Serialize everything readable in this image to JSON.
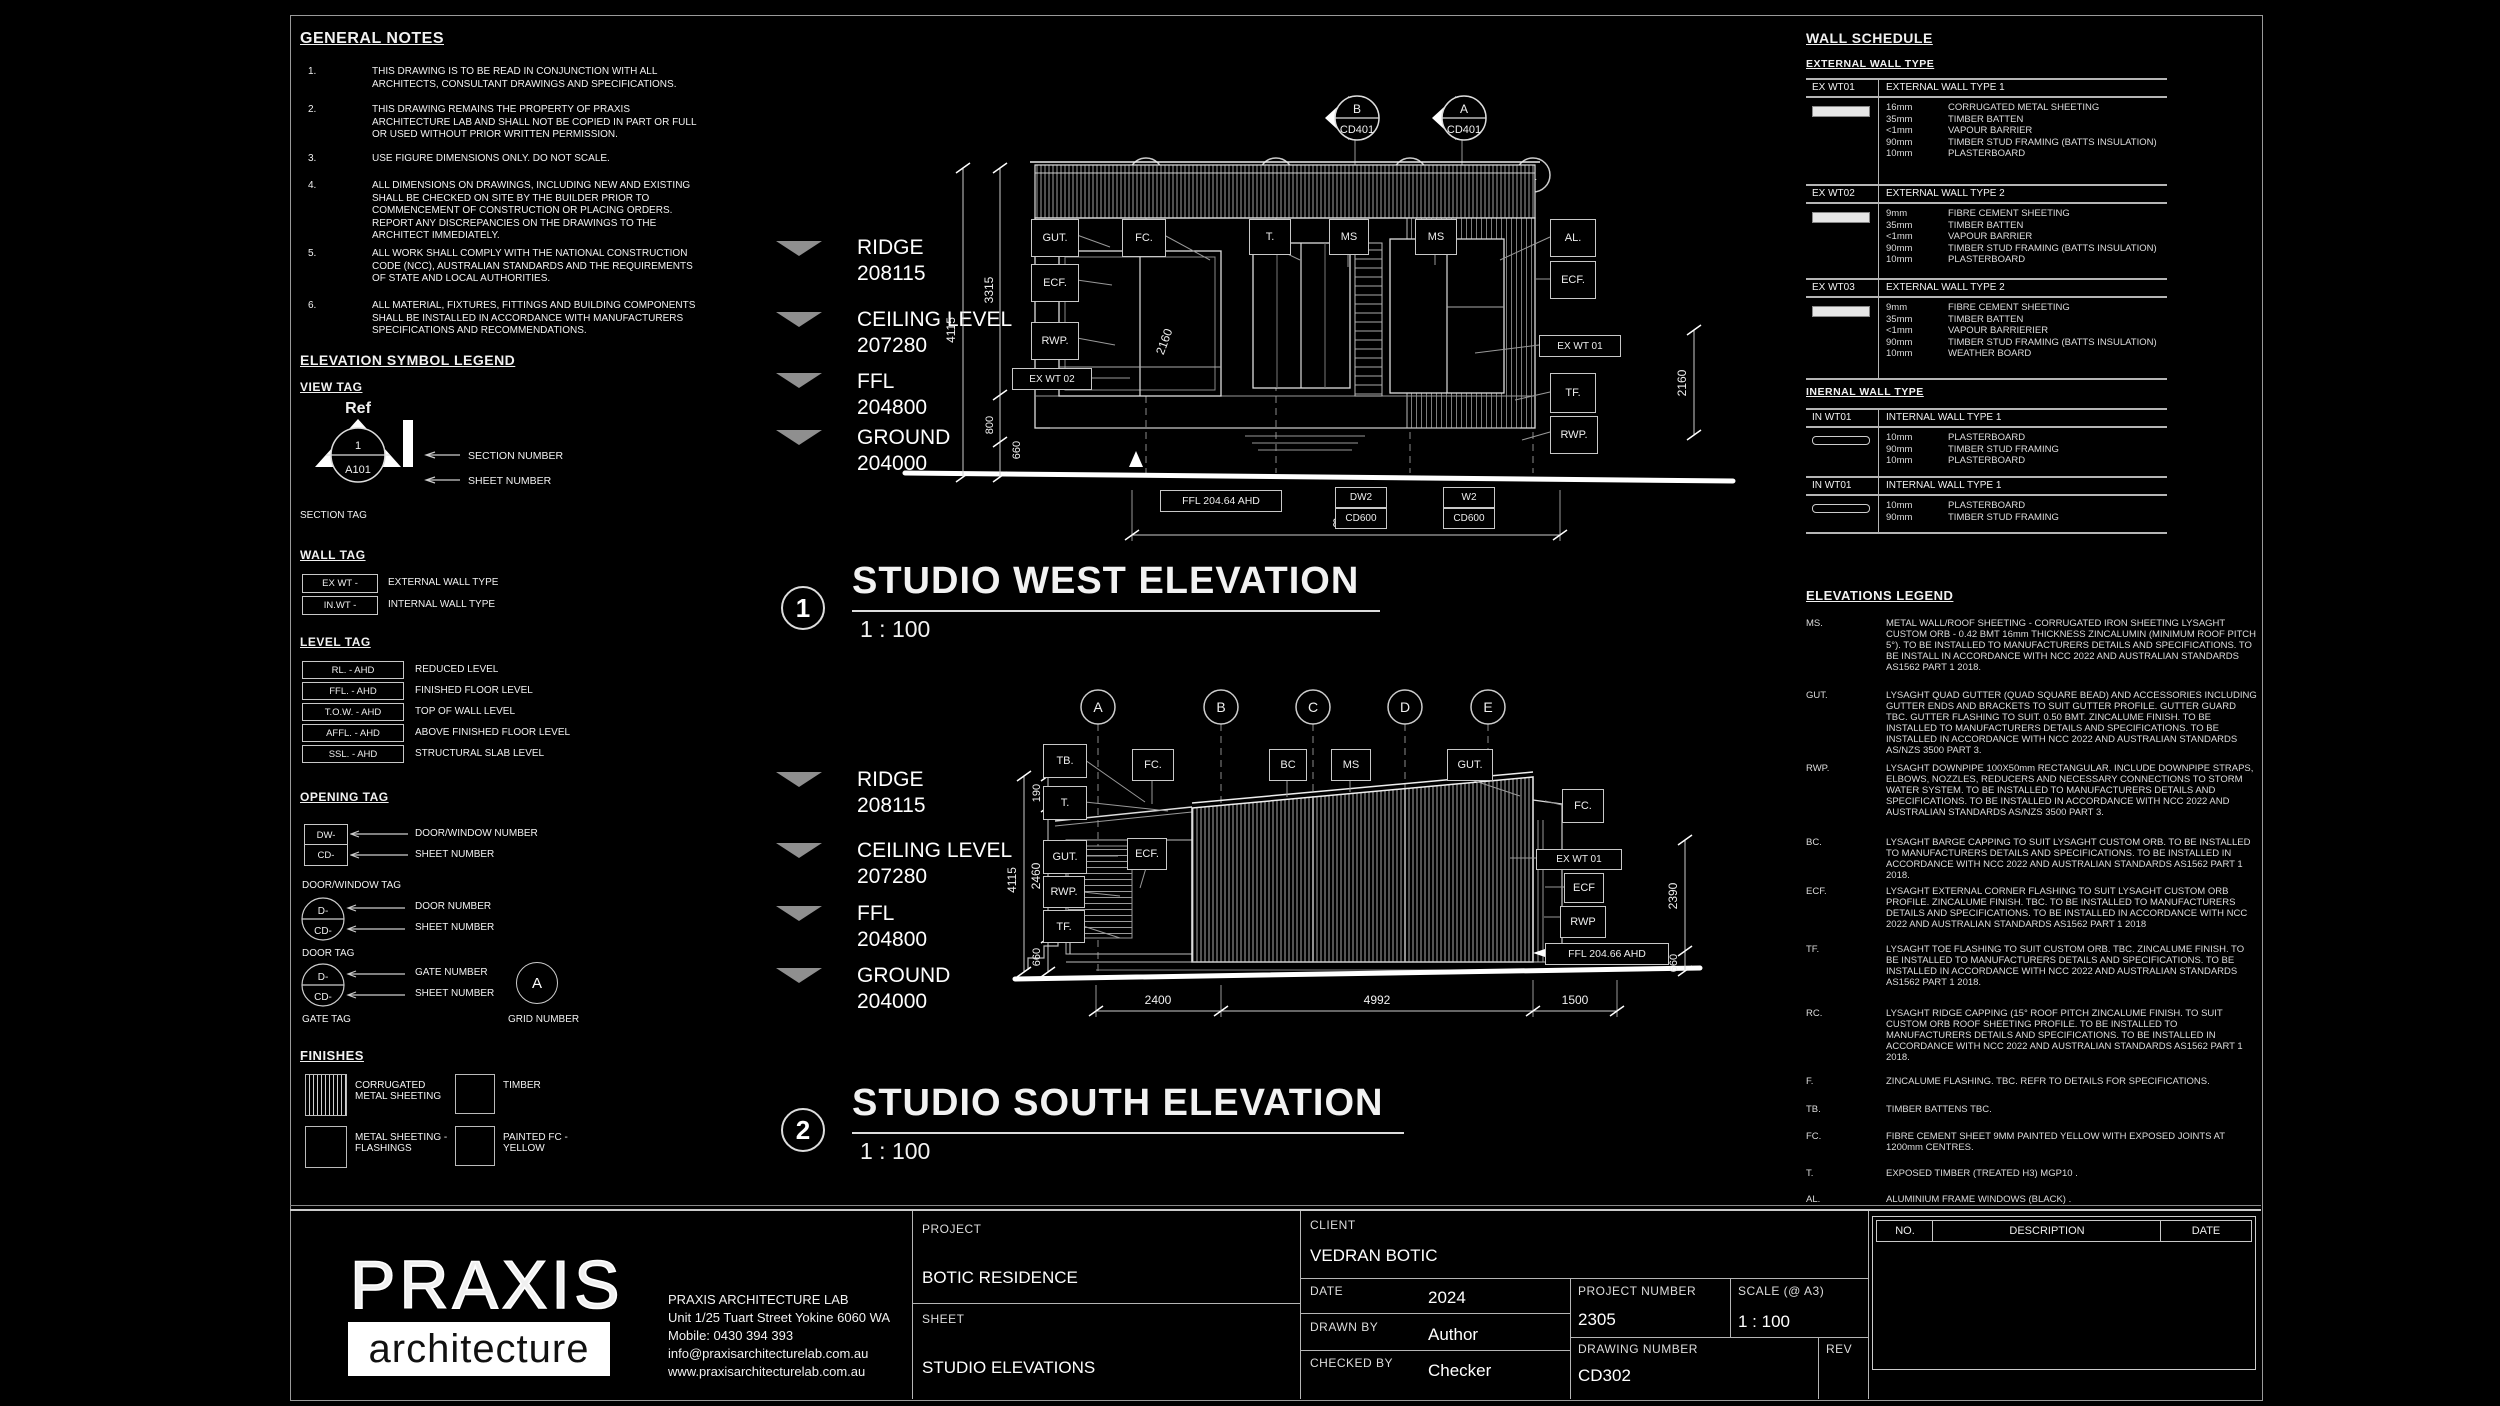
{
  "general_notes": {
    "title": "GENERAL NOTES",
    "items": [
      {
        "num": "1.",
        "text": "THIS DRAWING IS TO BE READ IN CONJUNCTION WITH ALL ARCHITECTS, CONSULTANT DRAWINGS AND SPECIFICATIONS."
      },
      {
        "num": "2.",
        "text": "THIS DRAWING REMAINS THE PROPERTY OF PRAXIS ARCHITECTURE LAB AND SHALL NOT BE COPIED IN PART OR FULL OR USED WITHOUT PRIOR WRITTEN PERMISSION."
      },
      {
        "num": "3.",
        "text": "USE FIGURE DIMENSIONS ONLY. DO NOT SCALE."
      },
      {
        "num": "4.",
        "text": "ALL DIMENSIONS ON DRAWINGS, INCLUDING NEW AND EXISTING SHALL BE CHECKED ON SITE BY THE BUILDER PRIOR TO COMMENCEMENT OF CONSTRUCTION OR PLACING ORDERS. REPORT ANY DISCREPANCIES ON THE DRAWINGS TO THE ARCHITECT IMMEDIATELY."
      },
      {
        "num": "5.",
        "text": "ALL WORK SHALL COMPLY WITH THE NATIONAL CONSTRUCTION CODE (NCC), AUSTRALIAN STANDARDS AND THE REQUIREMENTS OF STATE AND LOCAL AUTHORITIES."
      },
      {
        "num": "6.",
        "text": "ALL MATERIAL, FIXTURES, FITTINGS AND BUILDING COMPONENTS SHALL BE INSTALLED IN ACCORDANCE WITH MANUFACTURERS SPECIFICATIONS AND RECOMMENDATIONS."
      }
    ]
  },
  "symbol_legend": {
    "title": "ELEVATION SYMBOL LEGEND",
    "view_tag": {
      "title": "VIEW TAG",
      "ref": "Ref",
      "num": "1",
      "sheet": "A101",
      "section_number": "SECTION NUMBER",
      "sheet_number": "SHEET NUMBER",
      "caption": "SECTION TAG"
    },
    "wall_tag": {
      "title": "WALL TAG",
      "ex": "EX WT -",
      "ex_label": "EXTERNAL WALL TYPE",
      "in": "IN.WT -",
      "in_label": "INTERNAL WALL TYPE"
    },
    "level_tag": {
      "title": "LEVEL TAG",
      "rows": [
        [
          "RL. - AHD",
          "REDUCED LEVEL"
        ],
        [
          "FFL. - AHD",
          "FINISHED FLOOR LEVEL"
        ],
        [
          "T.O.W. - AHD",
          "TOP OF WALL LEVEL"
        ],
        [
          "AFFL. - AHD",
          "ABOVE FINISHED FLOOR LEVEL"
        ],
        [
          "SSL. - AHD",
          "STRUCTURAL SLAB LEVEL"
        ]
      ]
    },
    "opening_tag": {
      "title": "OPENING TAG",
      "dw": "DW-",
      "cd": "CD-",
      "dw_num": "DOOR/WINDOW NUMBER",
      "sheet_num": "SHEET NUMBER",
      "dw_caption": "DOOR/WINDOW TAG",
      "d": "D-",
      "cd2": "CD-",
      "door_num": "DOOR NUMBER",
      "sheet_num2": "SHEET NUMBER",
      "door_caption": "DOOR TAG",
      "d2": "D-",
      "cd3": "CD-",
      "gate_num": "GATE NUMBER",
      "sheet_num3": "SHEET NUMBER",
      "gate_caption": "GATE TAG",
      "grid_letter": "A",
      "grid_caption": "GRID NUMBER"
    },
    "finishes": {
      "title": "FINISHES",
      "items": [
        "CORRUGATED METAL SHEETING",
        "TIMBER",
        "METAL SHEETING - FLASHINGS",
        "PAINTED FC - YELLOW"
      ]
    }
  },
  "levels": [
    {
      "label": "RIDGE",
      "value": "208115"
    },
    {
      "label": "CEILING LEVEL",
      "value": "207280"
    },
    {
      "label": "FFL",
      "value": "204800"
    },
    {
      "label": "GROUND",
      "value": "204000"
    }
  ],
  "west": {
    "num": "1",
    "title": "STUDIO WEST ELEVATION",
    "scale": "1 : 100",
    "grids": [
      "4",
      "3",
      "2",
      "1"
    ],
    "sections": [
      {
        "letter": "B",
        "sheet": "CD401"
      },
      {
        "letter": "A",
        "sheet": "CD401"
      }
    ],
    "callouts": {
      "gut": "GUT.",
      "fc": "FC.",
      "t": "T.",
      "ms1": "MS",
      "ms2": "MS",
      "al": "AL.",
      "ecf_left": "ECF.",
      "rwp_left": "RWP.",
      "ex_wt_02": "EX WT 02",
      "ecf_right": "ECF.",
      "ex_wt_01": "EX WT 01",
      "tf": "TF.",
      "rwp_right": "RWP."
    },
    "dims": {
      "h_total": "4115",
      "h_upper": "3315",
      "h_800": "800",
      "h_660": "660",
      "right": "2160",
      "interior": "2160",
      "overall": "8892"
    },
    "tags": {
      "ffl": "FFL 204.64 AHD",
      "dw": "DW2",
      "dw_sheet": "CD600",
      "w": "W2",
      "w_sheet": "CD600"
    }
  },
  "south": {
    "num": "2",
    "title": "STUDIO SOUTH ELEVATION",
    "scale": "1 : 100",
    "grids": [
      "A",
      "B",
      "C",
      "D",
      "E"
    ],
    "callouts": {
      "tb": "TB.",
      "t": "T.",
      "gut_left": "GUT.",
      "rwp_left": "RWP.",
      "tf": "TF.",
      "fc_left": "FC.",
      "ecf_left": "ECF.",
      "bc": "BC",
      "ms": "MS",
      "gut_right": "GUT.",
      "fc_right": "FC.",
      "ex_wt_01": "EX WT 01",
      "ecf_right": "ECF",
      "rwp_right": "RWP"
    },
    "dims": {
      "h_total": "4115",
      "h_190": "190",
      "h_2460": "2460",
      "h_660": "660",
      "right_2390": "2390",
      "right_660": "660",
      "b1": "2400",
      "b2": "4992",
      "b3": "1500"
    },
    "tags": {
      "ffl": "FFL 204.66 AHD"
    }
  },
  "wall_schedule": {
    "title": "WALL SCHEDULE",
    "external_heading": "EXTERNAL WALL TYPE",
    "internal_heading": "INERNAL WALL TYPE",
    "external": [
      {
        "code": "EX WT01",
        "name": "EXTERNAL WALL TYPE 1",
        "layers": [
          [
            "16mm",
            "CORRUGATED METAL SHEETING"
          ],
          [
            "35mm",
            "TIMBER BATTEN"
          ],
          [
            "<1mm",
            "VAPOUR BARRIER"
          ],
          [
            "90mm",
            "TIMBER STUD FRAMING (BATTS INSULATION)"
          ],
          [
            "10mm",
            "PLASTERBOARD"
          ]
        ]
      },
      {
        "code": "EX WT02",
        "name": "EXTERNAL WALL TYPE 2",
        "layers": [
          [
            "9mm",
            "FIBRE CEMENT SHEETING"
          ],
          [
            "35mm",
            "TIMBER BATTEN"
          ],
          [
            "<1mm",
            "VAPOUR BARRIER"
          ],
          [
            "90mm",
            "TIMBER STUD FRAMING (BATTS INSULATION)"
          ],
          [
            "10mm",
            "PLASTERBOARD"
          ]
        ]
      },
      {
        "code": "EX WT03",
        "name": "EXTERNAL WALL TYPE 2",
        "layers": [
          [
            "9mm",
            "FIBRE CEMENT SHEETING"
          ],
          [
            "35mm",
            "TIMBER BATTEN"
          ],
          [
            "<1mm",
            "VAPOUR BARRIERIER"
          ],
          [
            "90mm",
            "TIMBER STUD FRAMING (BATTS INSULATION)"
          ],
          [
            "10mm",
            "WEATHER BOARD"
          ]
        ]
      }
    ],
    "internal": [
      {
        "code": "IN WT01",
        "name": "INTERNAL WALL TYPE 1",
        "layers": [
          [
            "10mm",
            "PLASTERBOARD"
          ],
          [
            "90mm",
            "TIMBER STUD FRAMING"
          ],
          [
            "10mm",
            "PLASTERBOARD"
          ]
        ]
      },
      {
        "code": "IN WT01",
        "name": "INTERNAL WALL TYPE 1",
        "layers": [
          [
            "10mm",
            "PLASTERBOARD"
          ],
          [
            "90mm",
            "TIMBER STUD FRAMING"
          ]
        ]
      }
    ]
  },
  "elevations_legend": {
    "title": "ELEVATIONS LEGEND",
    "entries": [
      {
        "key": "MS.",
        "text": "METAL WALL/ROOF SHEETING - CORRUGATED IRON SHEETING LYSAGHT CUSTOM ORB - 0.42 BMT 16mm THICKNESS ZINCALUMIN (MINIMUM ROOF PITCH 5°). TO BE INSTALLED TO MANUFACTURERS DETAILS AND SPECIFICATIONS. TO BE INSTALL IN ACCORDANCE WITH NCC 2022 AND AUSTRALIAN STANDARDS AS1562 PART 1 2018."
      },
      {
        "key": "GUT.",
        "text": "LYSAGHT QUAD GUTTER (QUAD SQUARE BEAD) AND ACCESSORIES INCLUDING GUTTER ENDS AND BRACKETS TO SUIT GUTTER PROFILE. GUTTER GUARD TBC. GUTTER FLASHING TO SUIT. 0.50 BMT. ZINCALUME FINISH. TO BE INSTALLED TO MANUFACTURERS DETAILS AND SPECIFICATIONS. TO BE INSTALLED IN ACCORDANCE WITH NCC 2022 AND AUSTRALIAN STANDARDS AS/NZS 3500 PART 3."
      },
      {
        "key": "RWP.",
        "text": "LYSAGHT DOWNPIPE 100X50mm RECTANGULAR. INCLUDE DOWNPIPE STRAPS, ELBOWS, NOZZLES, REDUCERS AND NECESSARY CONNECTIONS TO STORM WATER SYSTEM. TO BE INSTALLED TO MANUFACTURERS DETAILS AND SPECIFICATIONS. TO BE INSTALLED IN ACCORDANCE WITH NCC 2022 AND AUSTRALIAN STANDARDS AS/NZS 3500 PART 3."
      },
      {
        "key": "BC.",
        "text": "LYSAGHT BARGE CAPPING TO SUIT LYSAGHT CUSTOM ORB. TO BE INSTALLED TO MANUFACTURERS DETAILS AND SPECIFICATIONS. TO BE INSTALLED IN ACCORDANCE WITH NCC 2022 AND AUSTRALIAN STANDARDS AS1562 PART 1 2018."
      },
      {
        "key": "ECF.",
        "text": "LYSAGHT EXTERNAL CORNER FLASHING TO SUIT LYSAGHT CUSTOM ORB PROFILE. ZINCALUME FINISH. TBC. TO BE INSTALLED TO MANUFACTURERS DETAILS AND SPECIFICATIONS. TO BE INSTALLED IN ACCORDANCE WITH NCC 2022 AND AUSTRALIAN STANDARDS AS1562 PART 1 2018"
      },
      {
        "key": "TF.",
        "text": "LYSAGHT TOE FLASHING TO SUIT CUSTOM ORB. TBC. ZINCALUME FINISH. TO BE INSTALLED TO MANUFACTURERS DETAILS AND SPECIFICATIONS. TO BE INSTALLED IN ACCORDANCE WITH NCC 2022 AND AUSTRALIAN  STANDARDS AS1562 PART 1 2018."
      },
      {
        "key": "RC.",
        "text": "LYSAGHT RIDGE CAPPING (15° ROOF PITCH ZINCALUME FINISH. TO SUIT CUSTOM ORB ROOF SHEETING PROFILE. TO BE INSTALLED TO MANUFACTURERS DETAILS AND SPECIFICATIONS. TO BE INSTALLED IN ACCORDANCE WITH NCC 2022 AND AUSTRALIAN STANDARDS AS1562 PART 1 2018."
      },
      {
        "key": "F.",
        "text": "ZINCALUME FLASHING. TBC. REFR TO DETAILS FOR SPECIFICATIONS."
      },
      {
        "key": "TB.",
        "text": "TIMBER BATTENS TBC."
      },
      {
        "key": "FC.",
        "text": "FIBRE CEMENT SHEET 9MM PAINTED YELLOW WITH EXPOSED JOINTS AT 1200mm CENTRES."
      },
      {
        "key": "T.",
        "text": "EXPOSED TIMBER (TREATED H3) MGP10 ."
      },
      {
        "key": "AL.",
        "text": "ALUMINIUM FRAME WINDOWS (BLACK) ."
      }
    ]
  },
  "titleblock": {
    "logo_top": "PRAXIS",
    "logo_bottom": "architecture",
    "contact": [
      "PRAXIS ARCHITECTURE LAB",
      "Unit 1/25 Tuart Street Yokine 6060 WA",
      "Mobile: 0430 394 393",
      "info@praxisarchitecturelab.com.au",
      "www.praxisarchitecturelab.com.au"
    ],
    "project_label": "PROJECT",
    "project": "BOTIC RESIDENCE",
    "sheet_label": "SHEET",
    "sheet": "STUDIO ELEVATIONS",
    "client_label": "CLIENT",
    "client": "VEDRAN BOTIC",
    "date_label": "DATE",
    "date": "2024",
    "drawn_label": "DRAWN BY",
    "drawn": "Author",
    "checked_label": "CHECKED BY",
    "checked": "Checker",
    "project_number_label": "PROJECT NUMBER",
    "project_number": "2305",
    "scale_label": "SCALE (@ A3)",
    "scale": "1 : 100",
    "drawing_number_label": "DRAWING NUMBER",
    "drawing_number": "CD302",
    "rev_label": "REV",
    "rev_table": {
      "no": "NO.",
      "description": "DESCRIPTION",
      "date": "DATE"
    }
  },
  "colors": {
    "background": "#000000",
    "line": "#ffffff",
    "muted": "#8f8f8f"
  }
}
